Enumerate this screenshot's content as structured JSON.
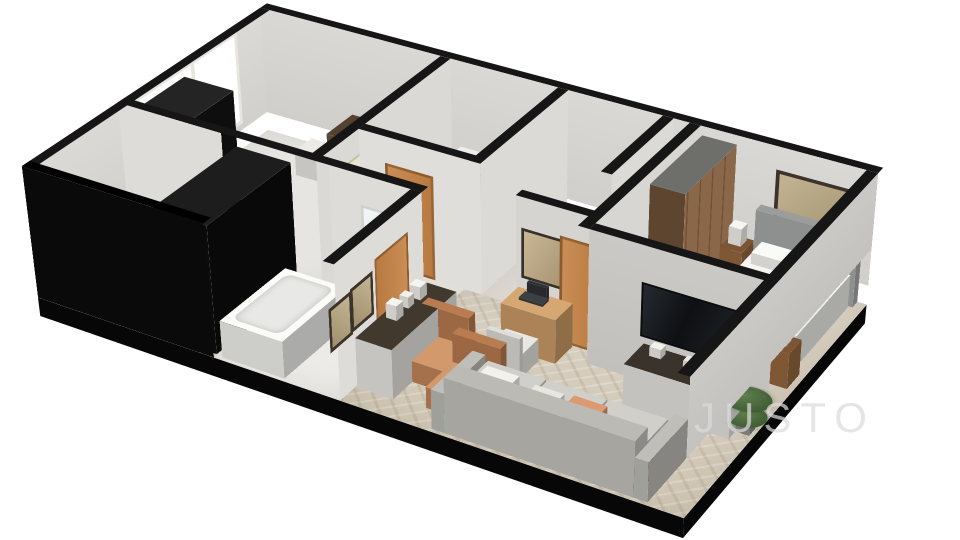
{
  "watermark": {
    "text": "JUSTO"
  },
  "scene": {
    "type": "3d-isometric-floorplan-render",
    "background": "#ffffff",
    "rooms": [
      "kitchen-dining",
      "wc-laundry",
      "hallway",
      "bathroom",
      "living-room",
      "bedroom"
    ]
  },
  "colors": {
    "black_wall": "#0a0a0a",
    "cap_dark": "#161616",
    "wall_light": "#d8d6d2",
    "wall_white": "#e2e0dc",
    "floor_wood": "#d7cfc0",
    "floor_stone": "#e7e5e1",
    "carpet": "#dbd2c3",
    "door_accent": "#c98e55",
    "door_cream": "#e8e4d8",
    "wood_light": "#cb9c66",
    "wood_dark": "#53402f",
    "sofa_gray": "#d0cfc9",
    "sofa_base": "#3a342e",
    "armchair": "#c5875c",
    "salmon": "#dd9a70",
    "bed_white": "#f2f1ed",
    "headboard": "#a9abaa",
    "nightstand": "#96683f",
    "wardrobe": "#8a6749",
    "tv_black": "#17191b",
    "plant_green": "#5f7f4e",
    "tub_white": "#f4f4f1",
    "watermark_gray": "#dcdcdc"
  }
}
